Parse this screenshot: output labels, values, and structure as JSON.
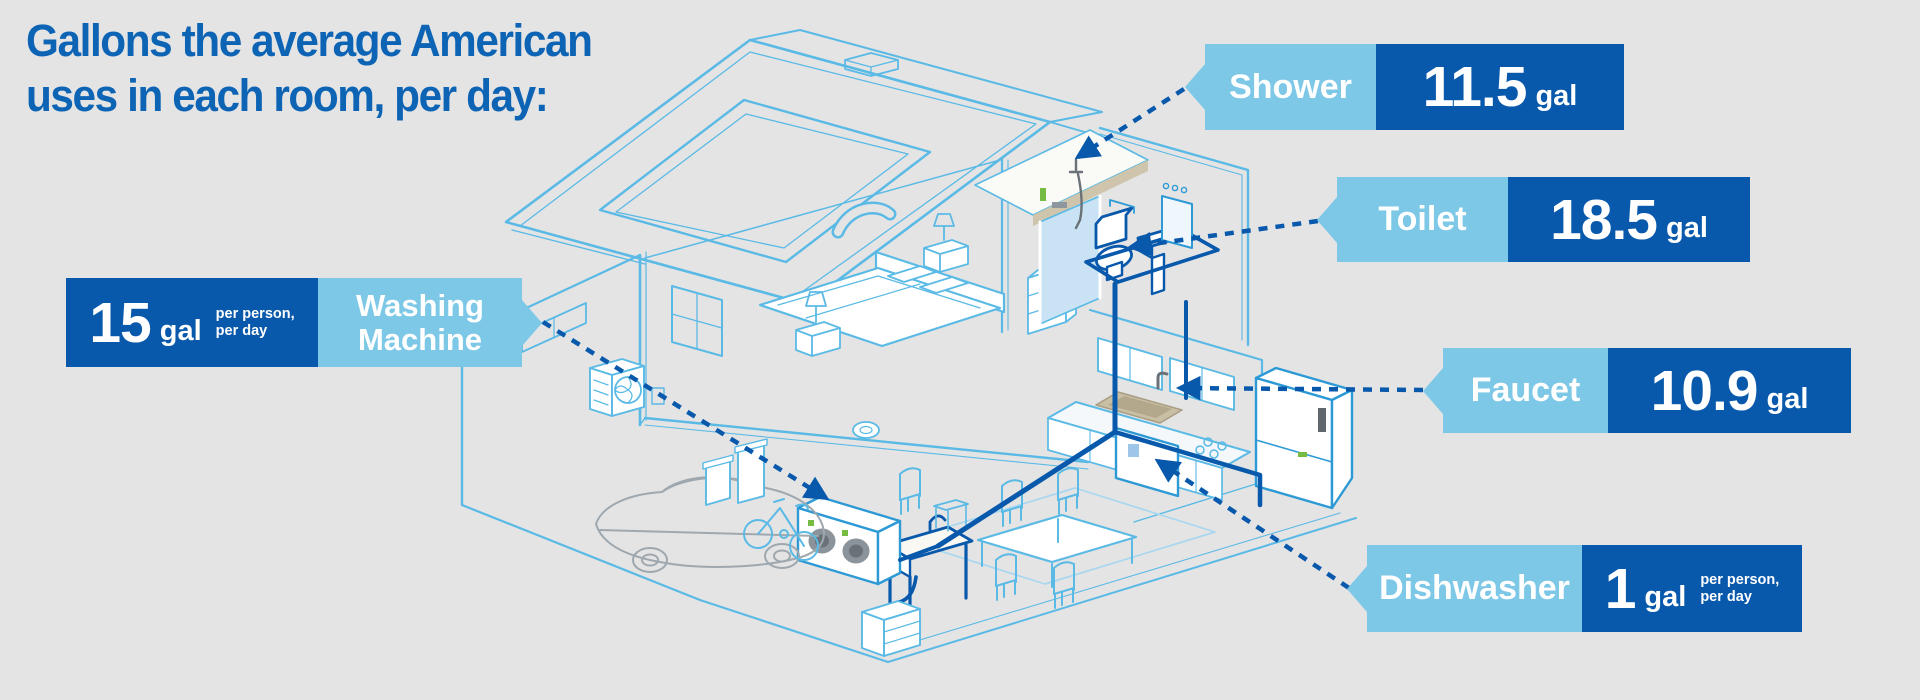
{
  "background_color": "#E4E4E5",
  "title": {
    "line1": "Gallons the average American",
    "line2": "uses in each room, per day:",
    "color": "#0E64B4"
  },
  "callouts": {
    "shower": {
      "room": "Shower",
      "value": "11.5",
      "unit": "gal"
    },
    "toilet": {
      "room": "Toilet",
      "value": "18.5",
      "unit": "gal"
    },
    "faucet": {
      "room": "Faucet",
      "value": "10.9",
      "unit": "gal"
    },
    "dishwasher": {
      "room": "Dishwasher",
      "value": "1",
      "unit": "gal",
      "note_line1": "per person,",
      "note_line2": "per day"
    },
    "washing_machine": {
      "room_line1": "Washing",
      "room_line2": "Machine",
      "value": "15",
      "unit": "gal",
      "note_line1": "per person,",
      "note_line2": "per day"
    }
  },
  "colors": {
    "label_room_bg": "#7EC8E7",
    "label_value_bg": "#0858AB",
    "connector": "#0858AB",
    "line_light": "#5ABAE5",
    "line_medium": "#2D9AD6",
    "accent_green": "#76BC43",
    "counter_tan": "#C9BFA4"
  },
  "icons": {
    "callout_pointer": "triangle-pointer",
    "connector_arrow": "arrowhead"
  }
}
